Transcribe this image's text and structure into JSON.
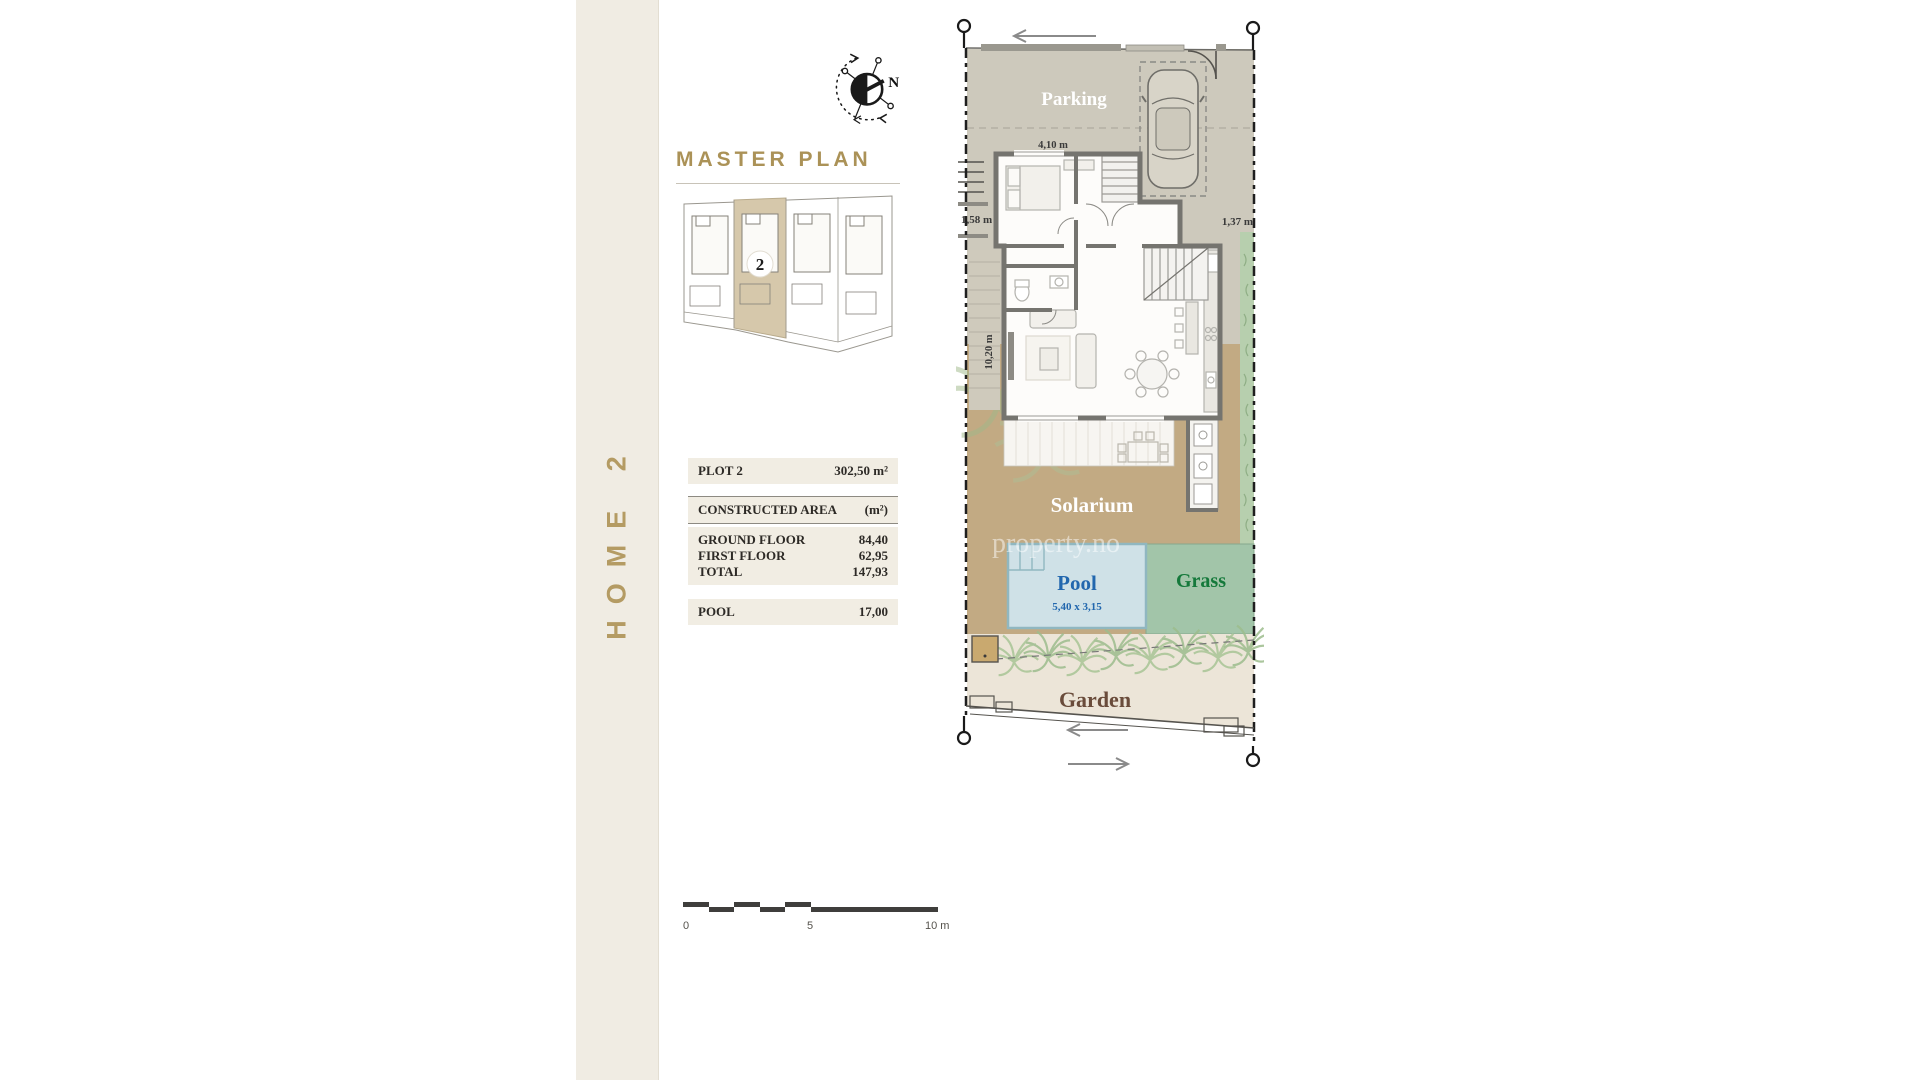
{
  "sidebar": {
    "label": "HOME 2"
  },
  "master_plan": {
    "title": "MASTER PLAN",
    "plot_number": "2"
  },
  "compass": {
    "north_label": "N"
  },
  "info_table": {
    "plot": {
      "label": "PLOT 2",
      "value": "302,50 m²"
    },
    "header": {
      "label": "CONSTRUCTED AREA",
      "value": "(m²)"
    },
    "rows": [
      {
        "label": "GROUND FLOOR",
        "value": "84,40"
      },
      {
        "label": "FIRST FLOOR",
        "value": "62,95"
      },
      {
        "label": "TOTAL",
        "value": "147,93"
      }
    ],
    "pool": {
      "label": "POOL",
      "value": "17,00"
    }
  },
  "scale_bar": {
    "tick_start": "0",
    "tick_middle": "5",
    "tick_end": "10 m"
  },
  "site_plan": {
    "areas": {
      "parking": "Parking",
      "solarium": "Solarium",
      "pool": "Pool",
      "pool_dimensions": "5,40 x 3,15",
      "grass": "Grass",
      "garden": "Garden"
    },
    "dimensions": {
      "bedroom_width": "4,10 m",
      "left_setback": "1,58 m",
      "right_setback": "1,37 m",
      "side_depth": "10,20 m"
    },
    "watermark": "property.no"
  },
  "colors": {
    "sidebar_bg": "#f0ece3",
    "accent_gold": "#b49b63",
    "table_row_bg": "#f1ede3",
    "parking_fill": "#cdc9bc",
    "solarium_fill": "#c2aa83",
    "pool_fill": "#cfe1e7",
    "pool_text": "#2267ae",
    "grass_fill": "#a2c5a9",
    "grass_text": "#15793b",
    "garden_fill": "#ece5d8",
    "garden_text": "#6a4c3b",
    "hedge_green": "#a8c596",
    "wall_gray": "#75746f"
  }
}
